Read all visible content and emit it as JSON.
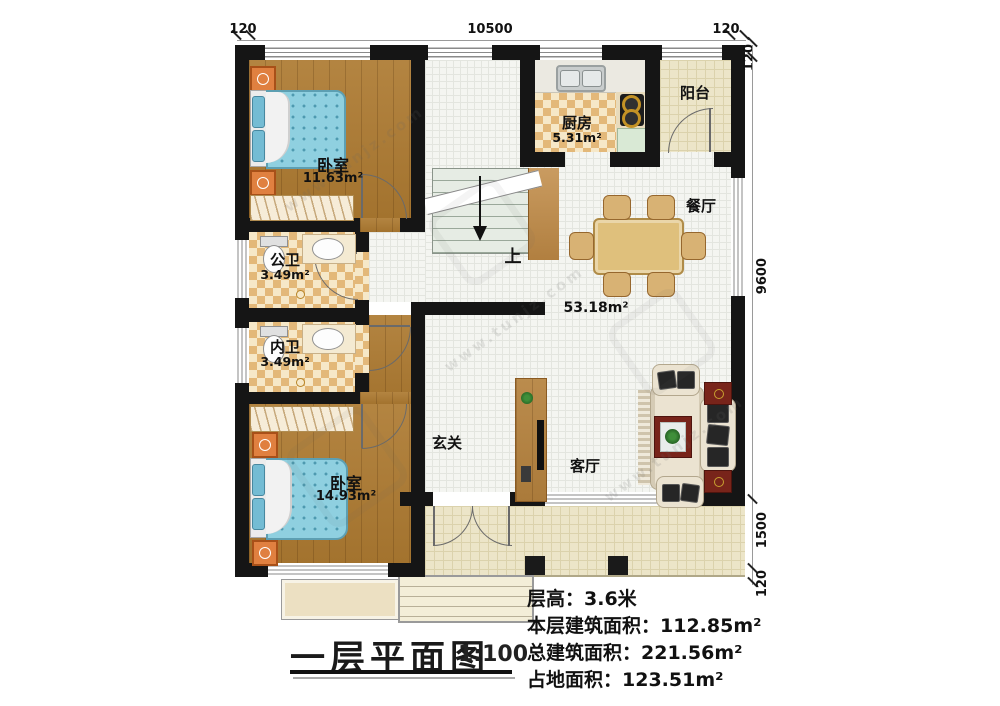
{
  "title": {
    "text": "一层平面图",
    "scale": "1:100"
  },
  "stats": [
    {
      "text": "层高：3.6米"
    },
    {
      "text": "本层建筑面积：112.85m²"
    },
    {
      "text": "总建筑面积：221.56m²"
    },
    {
      "text": "占地面积：123.51m²"
    }
  ],
  "rooms": {
    "bedroom1": {
      "name": "卧室",
      "area": "11.63m²"
    },
    "bath_public": {
      "name": "公卫",
      "area": "3.49m²"
    },
    "bath_inner": {
      "name": "内卫",
      "area": "3.49m²"
    },
    "bedroom2": {
      "name": "卧室",
      "area": "14.93m²"
    },
    "kitchen": {
      "name": "厨房",
      "area": "5.31m²"
    },
    "balcony": {
      "name": "阳台"
    },
    "dining": {
      "name": "餐厅"
    },
    "living": {
      "name": "客厅"
    },
    "foyer": {
      "name": "玄关"
    },
    "open_area": "53.18m²",
    "stairs_up": "上"
  },
  "dims": {
    "top_left": "120",
    "top_span": "10500",
    "top_right": "120",
    "right_wall": "120",
    "right_main": "9600",
    "right_porch": "1500",
    "right_bottom": "120"
  },
  "watermark": "www.tunjz.com",
  "colors": {
    "wall": "#151515",
    "wood_floor": "#ad7a31",
    "checker_tile": "#e3b879",
    "white_tile": "#f4f5f1",
    "porch_tile": "#ece5c8",
    "bed_blue": "#8fd0e0",
    "nightstand_orange": "#e08040",
    "table_wood": "#dfc07c",
    "coffee_table_red": "#78241a"
  }
}
